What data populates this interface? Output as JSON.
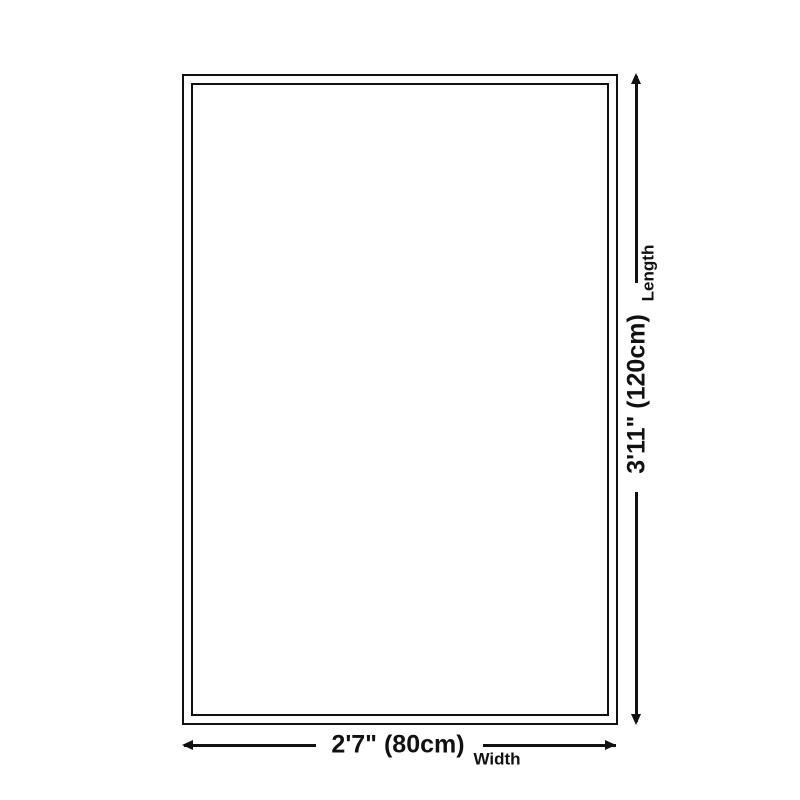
{
  "diagram": {
    "background_color": "#ffffff",
    "line_color": "#111111",
    "length_dimension": {
      "value": "3'11\" (120cm)",
      "label": "Length"
    },
    "width_dimension": {
      "value": "2'7\" (80cm)",
      "label": "Width"
    }
  }
}
